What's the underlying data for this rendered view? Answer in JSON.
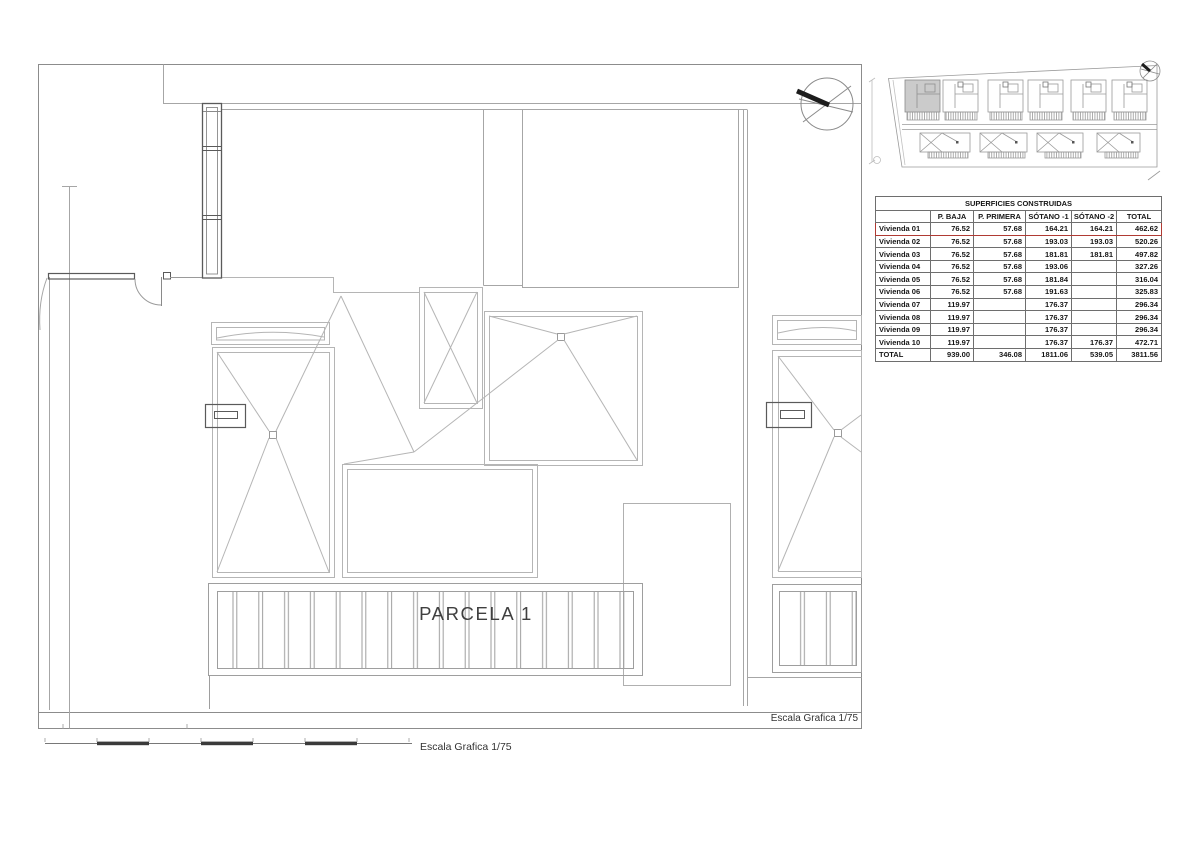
{
  "plan": {
    "parcel_label": "PARCELA 1",
    "frame_scale_label": "Escala Grafica 1/75",
    "bottom_scale_label": "Escala Grafica 1/75"
  },
  "table": {
    "title": "SUPERFICIES CONSTRUIDAS",
    "columns": [
      "",
      "P. BAJA",
      "P. PRIMERA",
      "SÓTANO -1",
      "SÓTANO -2",
      "TOTAL"
    ],
    "rows": [
      {
        "label": "Vivienda 01",
        "p_baja": "76.52",
        "p_primera": "57.68",
        "sotano1": "164.21",
        "sotano2": "164.21",
        "total": "462.62"
      },
      {
        "label": "Vivienda 02",
        "p_baja": "76.52",
        "p_primera": "57.68",
        "sotano1": "193.03",
        "sotano2": "193.03",
        "total": "520.26"
      },
      {
        "label": "Vivienda 03",
        "p_baja": "76.52",
        "p_primera": "57.68",
        "sotano1": "181.81",
        "sotano2": "181.81",
        "total": "497.82"
      },
      {
        "label": "Vivienda 04",
        "p_baja": "76.52",
        "p_primera": "57.68",
        "sotano1": "193.06",
        "sotano2": "",
        "total": "327.26"
      },
      {
        "label": "Vivienda 05",
        "p_baja": "76.52",
        "p_primera": "57.68",
        "sotano1": "181.84",
        "sotano2": "",
        "total": "316.04"
      },
      {
        "label": "Vivienda 06",
        "p_baja": "76.52",
        "p_primera": "57.68",
        "sotano1": "191.63",
        "sotano2": "",
        "total": "325.83"
      },
      {
        "label": "Vivienda 07",
        "p_baja": "119.97",
        "p_primera": "",
        "sotano1": "176.37",
        "sotano2": "",
        "total": "296.34"
      },
      {
        "label": "Vivienda 08",
        "p_baja": "119.97",
        "p_primera": "",
        "sotano1": "176.37",
        "sotano2": "",
        "total": "296.34"
      },
      {
        "label": "Vivienda 09",
        "p_baja": "119.97",
        "p_primera": "",
        "sotano1": "176.37",
        "sotano2": "",
        "total": "296.34"
      },
      {
        "label": "Vivienda 10",
        "p_baja": "119.97",
        "p_primera": "",
        "sotano1": "176.37",
        "sotano2": "176.37",
        "total": "472.71"
      },
      {
        "label": "TOTAL",
        "p_baja": "939.00",
        "p_primera": "346.08",
        "sotano1": "1811.06",
        "sotano2": "539.05",
        "total": "3811.56"
      }
    ],
    "highlight_color": "#b03a33"
  },
  "colors": {
    "line_light": "#b5b5b5",
    "line_medium": "#9a9a9a",
    "line_dark": "#5a5a5a",
    "thumbnail_highlight_fill": "#cbcbcb",
    "north_arrow": "#1c1c1c"
  },
  "icons": {
    "north_arrow_main": "north-arrow-compass",
    "north_arrow_thumbnail": "north-arrow-compass-small"
  }
}
